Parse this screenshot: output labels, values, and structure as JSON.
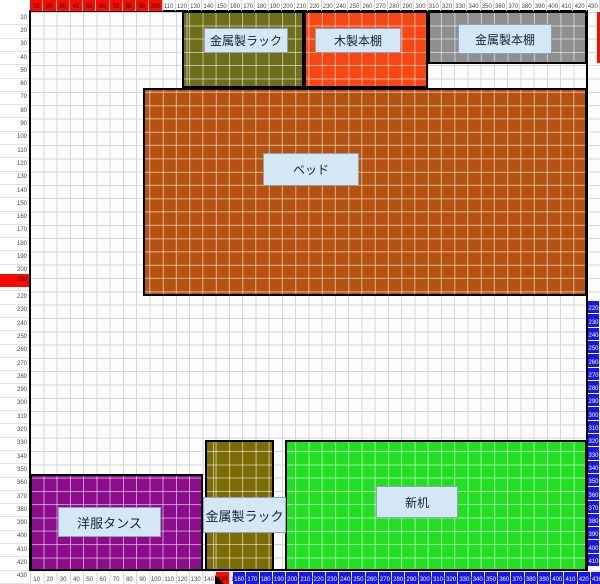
{
  "app": {
    "description_label": "room-furniture-layout-grid"
  },
  "colors": {
    "ruler_red": "#f80c00",
    "ruler_blue": "#1717e8",
    "grid_line": "#d6d6d6",
    "wall": "#000000",
    "labelbox_bg": "#d4e7f5",
    "labelbox_border": "#91a3b6"
  },
  "grid": {
    "cols": 43,
    "rows": 43,
    "origin_x": 30,
    "origin_y": 12,
    "cell_w": 13.2558,
    "cell_h": 13.3023,
    "room": {
      "left": 30,
      "top": 11,
      "right": 588,
      "bottom": 571
    }
  },
  "rulers": {
    "top": {
      "labels": [
        "10",
        "20",
        "30",
        "40",
        "50",
        "60",
        "70",
        "80",
        "90",
        "100",
        "110",
        "120",
        "130",
        "140",
        "150",
        "160",
        "170",
        "180",
        "190",
        "200",
        "210",
        "220",
        "230",
        "240",
        "250",
        "260",
        "270",
        "280",
        "290",
        "300",
        "310",
        "320",
        "330",
        "340",
        "350",
        "360",
        "370",
        "380",
        "390",
        "400",
        "410",
        "420",
        "430"
      ],
      "red_count": 10
    },
    "left": {
      "labels": [
        "10",
        "20",
        "30",
        "40",
        "50",
        "60",
        "70",
        "80",
        "90",
        "100",
        "110",
        "120",
        "130",
        "140",
        "150",
        "160",
        "170",
        "180",
        "190",
        "200",
        "210",
        "220",
        "230",
        "240",
        "250",
        "260",
        "270",
        "280",
        "290",
        "300",
        "310",
        "320",
        "330",
        "340",
        "350",
        "360",
        "370",
        "380",
        "390",
        "400",
        "410",
        "420",
        "430"
      ],
      "red_cell": {
        "y": 274,
        "label": "200"
      }
    },
    "bottom": {
      "labels": [
        "10",
        "20",
        "30",
        "40",
        "50",
        "60",
        "70",
        "80",
        "90",
        "100",
        "110",
        "120",
        "130",
        "140",
        "150",
        "160",
        "170",
        "180",
        "190",
        "200",
        "210",
        "220",
        "230",
        "240",
        "250",
        "260",
        "270",
        "280",
        "290",
        "300",
        "310",
        "320",
        "330",
        "340",
        "350",
        "360",
        "370",
        "380",
        "390",
        "400",
        "410",
        "420",
        "430"
      ],
      "red_cell": {
        "x": 216,
        "label": "150"
      },
      "blue_start_x": 233,
      "blue_labels": [
        "160",
        "170",
        "180",
        "190",
        "200",
        "210",
        "220",
        "230",
        "240",
        "250",
        "260",
        "270",
        "280",
        "290",
        "300",
        "310",
        "320",
        "330",
        "340",
        "350",
        "360",
        "370",
        "380",
        "390",
        "400",
        "410",
        "420",
        "430"
      ]
    },
    "right": {
      "blue_start_y": 301,
      "blue_labels": [
        "220",
        "230",
        "240",
        "250",
        "260",
        "270",
        "280",
        "290",
        "300",
        "310",
        "320",
        "330",
        "340",
        "350",
        "360",
        "370",
        "380",
        "390",
        "400",
        "410"
      ],
      "red_strip": {
        "x": 597,
        "y": 12,
        "w": 3,
        "h": 51
      }
    }
  },
  "furniture": [
    {
      "name": "metal-rack-top",
      "label": "金属製ラック",
      "color": "#6d6f1a",
      "x": 182,
      "y": 11,
      "w": 122,
      "h": 77,
      "box": {
        "x": 204,
        "y": 28,
        "w": 84,
        "h": 25,
        "font": 12
      }
    },
    {
      "name": "wood-bookshelf",
      "label": "木製本棚",
      "color": "#f84712",
      "x": 304,
      "y": 11,
      "w": 124,
      "h": 77,
      "box": {
        "x": 315,
        "y": 28,
        "w": 86,
        "h": 25,
        "font": 12
      }
    },
    {
      "name": "metal-bookshelf",
      "label": "金属製本棚",
      "color": "#8f8f8f",
      "x": 428,
      "y": 11,
      "w": 159,
      "h": 53,
      "box": {
        "x": 458,
        "y": 24,
        "w": 94,
        "h": 30,
        "font": 12
      }
    },
    {
      "name": "bed",
      "label": "ベッド",
      "color": "#b5520f",
      "x": 143,
      "y": 88,
      "w": 444,
      "h": 208,
      "box": {
        "x": 263,
        "y": 153,
        "w": 96,
        "h": 33,
        "font": 12
      }
    },
    {
      "name": "clothes-dresser",
      "label": "洋服タンス",
      "color": "#8c0d8c",
      "x": 30,
      "y": 474,
      "w": 173,
      "h": 97,
      "box": {
        "x": 58,
        "y": 507,
        "w": 103,
        "h": 30,
        "font": 13
      }
    },
    {
      "name": "metal-rack-bottom",
      "label": "金属製ラック",
      "color": "#7c6c06",
      "x": 205,
      "y": 440,
      "w": 69,
      "h": 131,
      "box": {
        "x": 203,
        "y": 497,
        "w": 83,
        "h": 36,
        "font": 13
      }
    },
    {
      "name": "new-desk",
      "label": "新机",
      "color": "#23df23",
      "x": 285,
      "y": 440,
      "w": 302,
      "h": 131,
      "box": {
        "x": 376,
        "y": 486,
        "w": 82,
        "h": 32,
        "font": 12
      }
    }
  ],
  "markers": {
    "bottom_black": {
      "x": 215,
      "y": 575
    }
  }
}
